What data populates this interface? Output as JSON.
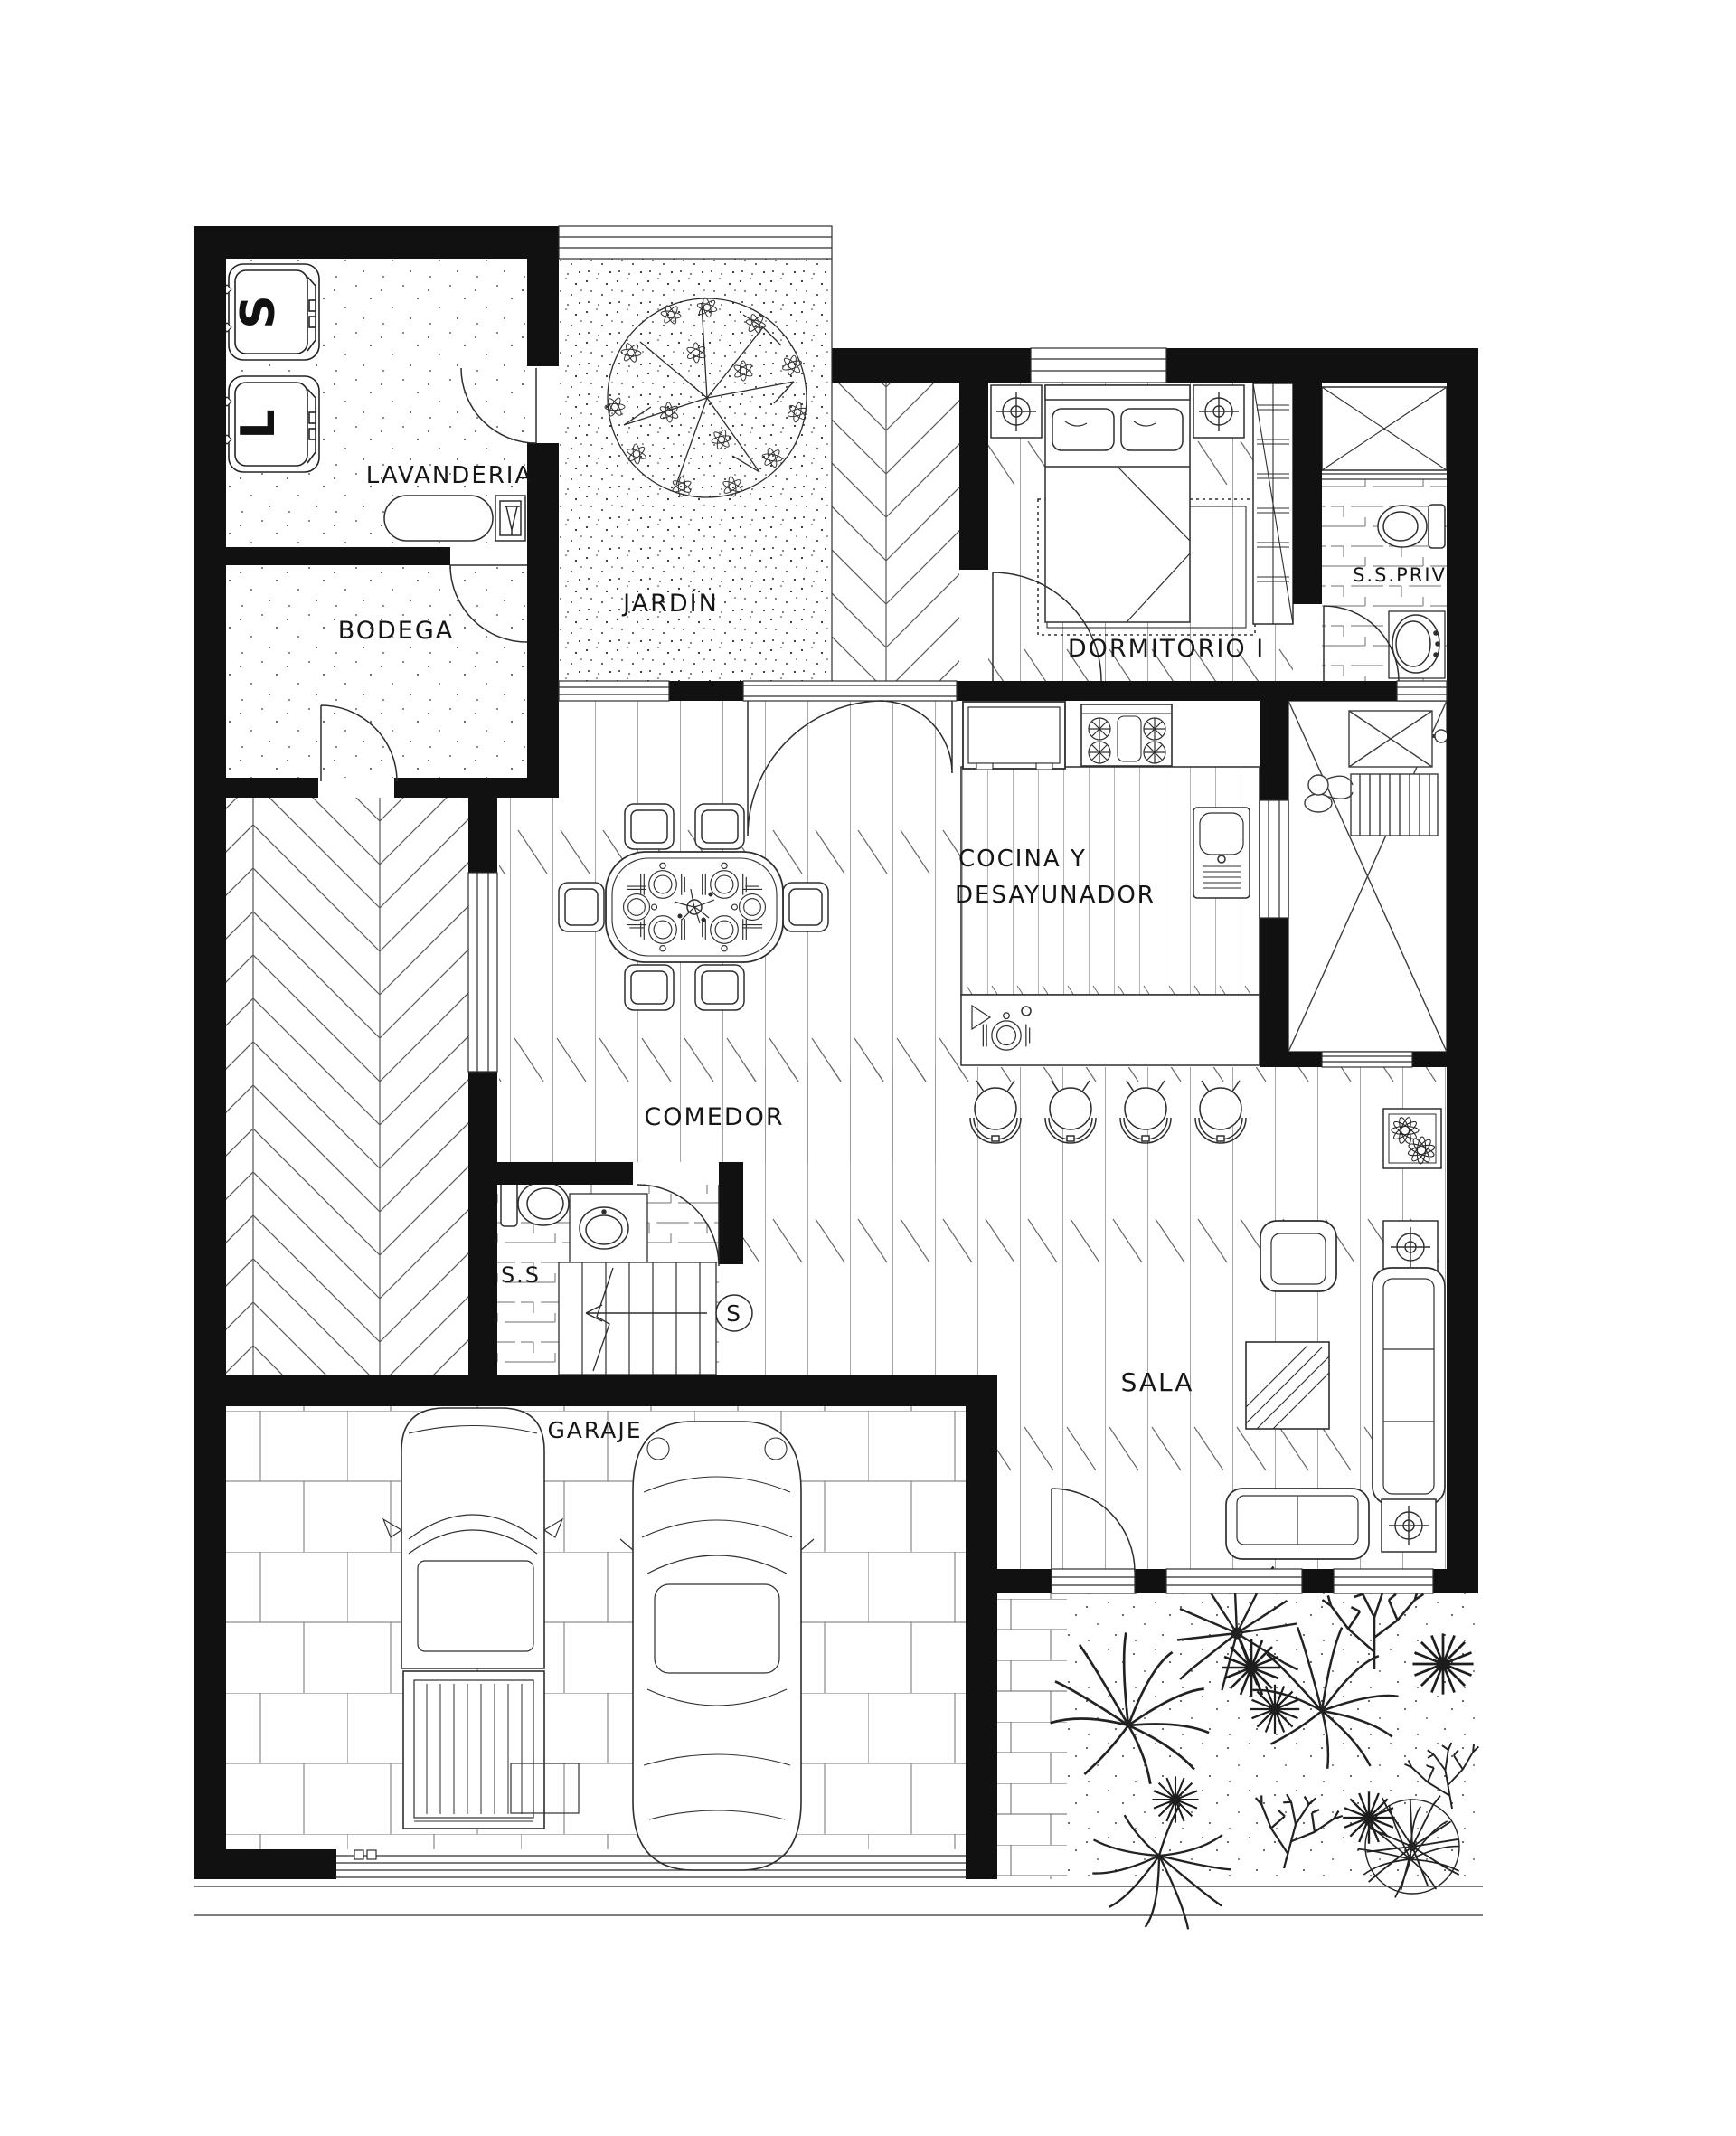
{
  "rooms": {
    "lavanderia": {
      "label": "LAVANDERIA"
    },
    "bodega": {
      "label": "BODEGA"
    },
    "jardin": {
      "label": "JARDÍN"
    },
    "dormitorio": {
      "label": "DORMITORIO I"
    },
    "ss_priv": {
      "label": "S.S.PRIV"
    },
    "cocina": {
      "line1": "COCINA Y",
      "line2": "DESAYUNADOR"
    },
    "comedor": {
      "label": "COMEDOR"
    },
    "ss": {
      "label": "S.S"
    },
    "sala": {
      "label": "SALA"
    },
    "garaje": {
      "label": "GARAJE"
    }
  },
  "appliances": {
    "dryer_letter": "S",
    "washer_letter": "L"
  },
  "stairs": {
    "up_letter": "S"
  },
  "colors": {
    "wall": "#111111",
    "line": "#3c3c3c",
    "text": "#161616",
    "background": "#ffffff"
  }
}
